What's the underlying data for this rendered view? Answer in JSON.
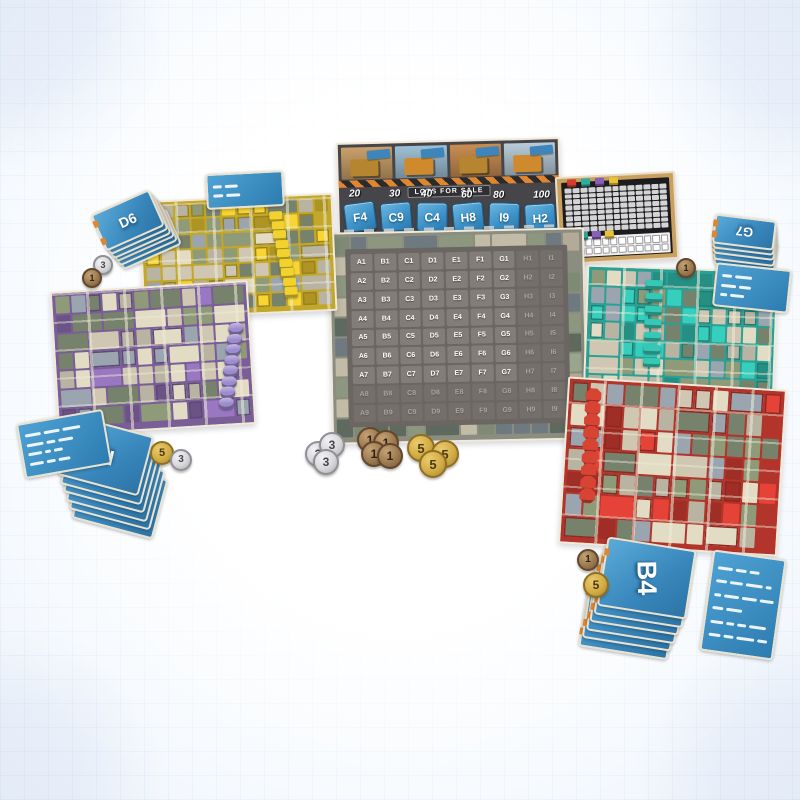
{
  "market_board": {
    "sign_text": "LOTS FOR SALE",
    "prices": [
      "20",
      "30",
      "40",
      "60",
      "80",
      "100"
    ],
    "lot_tiles": [
      "F4",
      "C9",
      "C4",
      "H8",
      "I9",
      "H2"
    ]
  },
  "city_grid": {
    "columns": [
      "A",
      "B",
      "C",
      "D",
      "E",
      "F",
      "G",
      "H",
      "I"
    ],
    "rows": [
      "1",
      "2",
      "3",
      "4",
      "5",
      "6",
      "7",
      "8",
      "9"
    ],
    "faded_columns": [
      "H",
      "I"
    ],
    "faded_rows": [
      "8",
      "9"
    ]
  },
  "score_board": {
    "marker_colors": [
      "#d63c2f",
      "#2fae9b",
      "#8a5fb8",
      "#e8c33a"
    ],
    "grid_rows": 8,
    "grid_cols": 13
  },
  "player_boards": [
    {
      "id": "yellow",
      "accent": "#d8b92c",
      "token_color": "#f2d22e",
      "token_shape": "cube",
      "token_count": 9
    },
    {
      "id": "purple",
      "accent": "#8668a8",
      "token_color": "#9d8bce",
      "token_shape": "cylinder",
      "token_count": 8
    },
    {
      "id": "teal",
      "accent": "#2fb3a4",
      "token_color": "#35c8b5",
      "token_shape": "bar",
      "token_count": 7
    },
    {
      "id": "red",
      "accent": "#c73a30",
      "token_color": "#d84434",
      "token_shape": "octagon",
      "token_count": 9
    }
  ],
  "card_fans": [
    {
      "id": "d6",
      "label": "D6",
      "count": 6
    },
    {
      "id": "g7",
      "label": "G7",
      "count": 5
    },
    {
      "id": "i2",
      "label": "I2",
      "count": 6
    },
    {
      "id": "b4",
      "label": "B4",
      "count": 6
    }
  ],
  "reference_card_count": 4,
  "coins": {
    "denominations": [
      {
        "value": "1",
        "metal": "bronze"
      },
      {
        "value": "3",
        "metal": "silver"
      },
      {
        "value": "5",
        "metal": "gold"
      }
    ],
    "groups": [
      {
        "id": "center-silver",
        "values": [
          "3",
          "3",
          "3"
        ]
      },
      {
        "id": "center-bronze",
        "values": [
          "1",
          "1",
          "1",
          "1"
        ]
      },
      {
        "id": "center-gold",
        "values": [
          "5",
          "5",
          "5"
        ]
      },
      {
        "id": "left-pair",
        "values": [
          "5",
          "3"
        ]
      },
      {
        "id": "upper-left-pair",
        "values": [
          "3",
          "1"
        ]
      },
      {
        "id": "right-single",
        "values": [
          "1"
        ]
      },
      {
        "id": "lower-right-pair",
        "values": [
          "1",
          "5"
        ]
      }
    ]
  }
}
